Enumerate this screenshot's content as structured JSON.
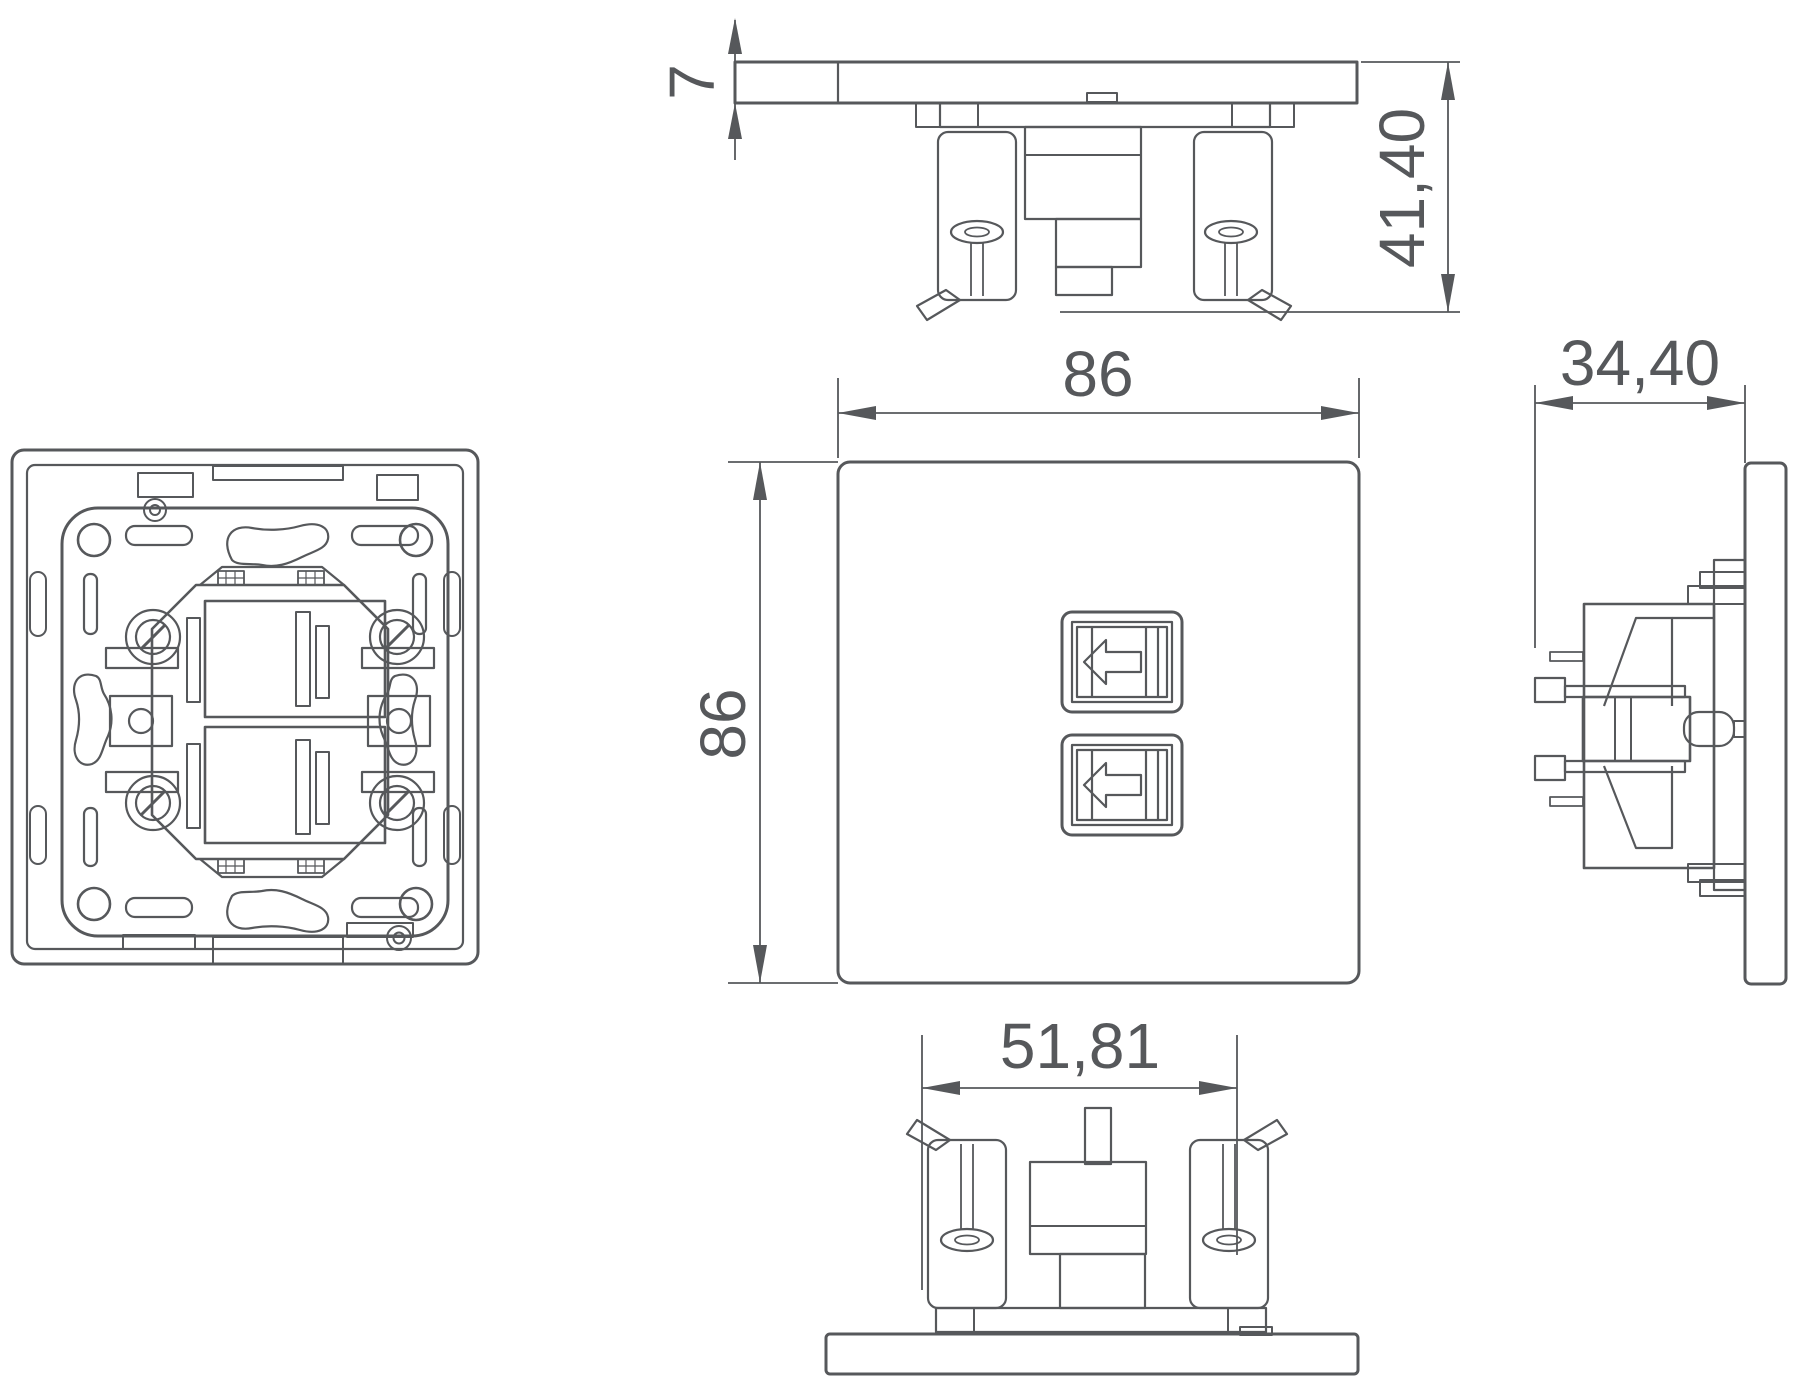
{
  "drawing": {
    "background_color": "#ffffff",
    "line_color": "#56585b",
    "text_color": "#56585b",
    "dimension_labels": {
      "plate_thickness": "7",
      "front_width": "86",
      "front_height": "86",
      "mount_depth": "41,40",
      "total_depth": "34,40",
      "mechanism_width": "51,81"
    }
  }
}
